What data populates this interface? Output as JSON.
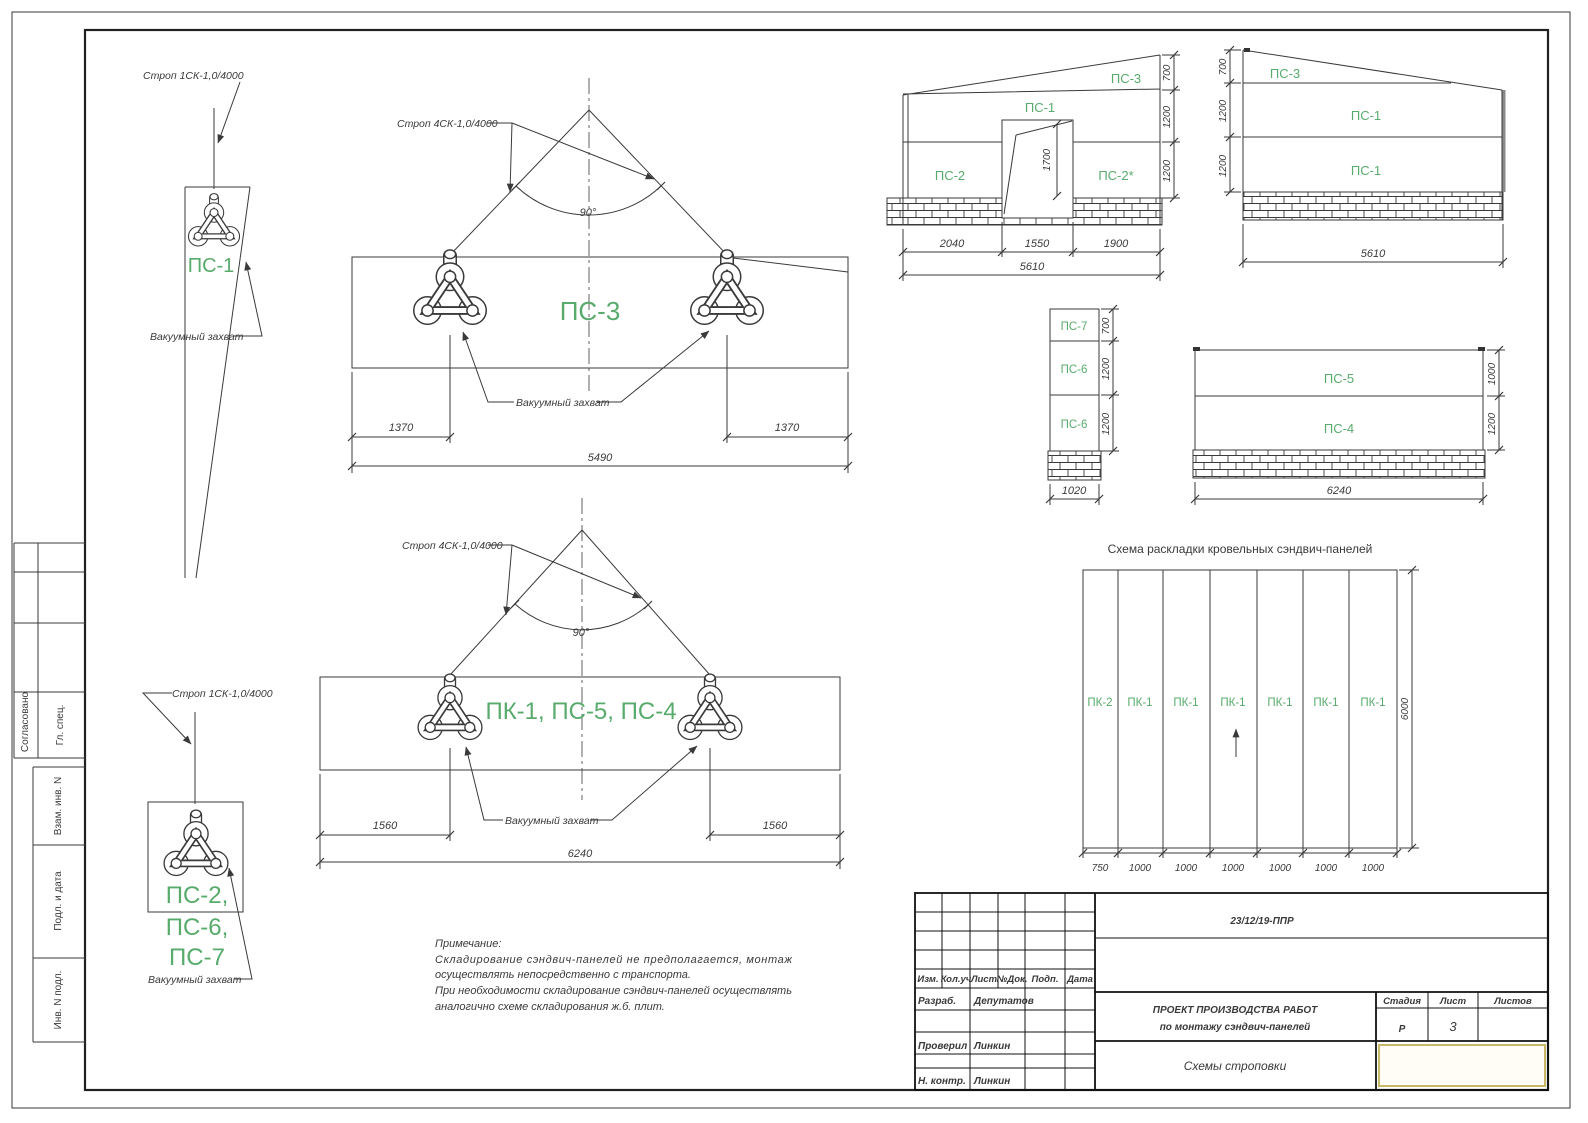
{
  "colors": {
    "green": "#58ab6c",
    "line": "#3a3a3a",
    "accent_box": "#c9b768"
  },
  "sling_detail_top": {
    "strop": "Строп 1СК-1,0/4000",
    "panel": "ПС-1",
    "vacuum": "Вакуумный захват"
  },
  "sling_detail_bottom": {
    "strop": "Строп 1СК-1,0/4000",
    "panels": [
      "ПС-2,",
      "ПС-6,",
      "ПС-7"
    ],
    "vacuum": "Вакуумный захват"
  },
  "rig1": {
    "strop": "Строп 4СК-1,0/4000",
    "angle": "90°",
    "panel": "ПС-3",
    "vacuum": "Вакуумный захват",
    "dim_left": "1370",
    "dim_right": "1370",
    "dim_total": "5490"
  },
  "rig2": {
    "strop": "Строп 4СК-1,0/4000",
    "angle": "90°",
    "panel": "ПК-1, ПС-5, ПС-4",
    "vacuum": "Вакуумный захват",
    "dim_left": "1560",
    "dim_right": "1560",
    "dim_total": "6240"
  },
  "elev1": {
    "p_top": "ПС-3",
    "p_mid": "ПС-1",
    "p_left": "ПС-2",
    "p_right": "ПС-2*",
    "h1": "700",
    "h2": "1200",
    "h3": "1200",
    "door_h": "1700",
    "w1": "2040",
    "w2": "1550",
    "w3": "1900",
    "w_total": "5610"
  },
  "elev2": {
    "p_top": "ПС-3",
    "p_mid": "ПС-1",
    "p_bot": "ПС-1",
    "h1": "700",
    "h2": "1200",
    "h3": "1200",
    "w_total": "5610"
  },
  "stack": {
    "p1": "ПС-7",
    "p2": "ПС-6",
    "p3": "ПС-6",
    "h1": "700",
    "h2": "1200",
    "h3": "1200",
    "w": "1020"
  },
  "wall": {
    "p1": "ПС-5",
    "p2": "ПС-4",
    "h1": "1000",
    "h2": "1200",
    "w": "6240"
  },
  "roof": {
    "title": "Схема раскладки кровельных сэндвич-панелей",
    "cols": [
      "ПК-2",
      "ПК-1",
      "ПК-1",
      "ПК-1",
      "ПК-1",
      "ПК-1",
      "ПК-1"
    ],
    "widths": [
      "750",
      "1000",
      "1000",
      "1000",
      "1000",
      "1000",
      "1000"
    ],
    "height": "6000"
  },
  "note": {
    "title": "Примечание:",
    "line1": "Складирование сэндвич-панелей не предполагается, монтаж",
    "line2": "осуществлять непосредственно с транспорта.",
    "line3": "При необходимости складирование сэндвич-панелей осуществлять",
    "line4": "аналогично схеме складирования ж.б. плит."
  },
  "stamp": {
    "doc_number": "23/12/19-ППР",
    "header": [
      "Изм.",
      "Кол.уч",
      "Лист",
      "№Док.",
      "Подп.",
      "Дата"
    ],
    "row1_role": "Разраб.",
    "row1_name": "Депутатов",
    "row2_role": "Проверил",
    "row2_name": "Линкин",
    "row3_role": "Н. контр.",
    "row3_name": "Линкин",
    "title_line1": "ПРОЕКТ ПРОИЗВОДСТВА РАБОТ",
    "title_line2": "по монтажу сэндвич-панелей",
    "subtitle": "Схемы строповки",
    "stage_label": "Стадия",
    "sheet_label": "Лист",
    "sheets_label": "Листов",
    "stage": "Р",
    "sheet": "3",
    "sheets": ""
  },
  "side": {
    "approved": "Согласовано",
    "spec": "Гл. спец.",
    "vzam": "Взам. инв. N",
    "podp": "Подл. и дата",
    "inv": "Инв. N подл."
  }
}
